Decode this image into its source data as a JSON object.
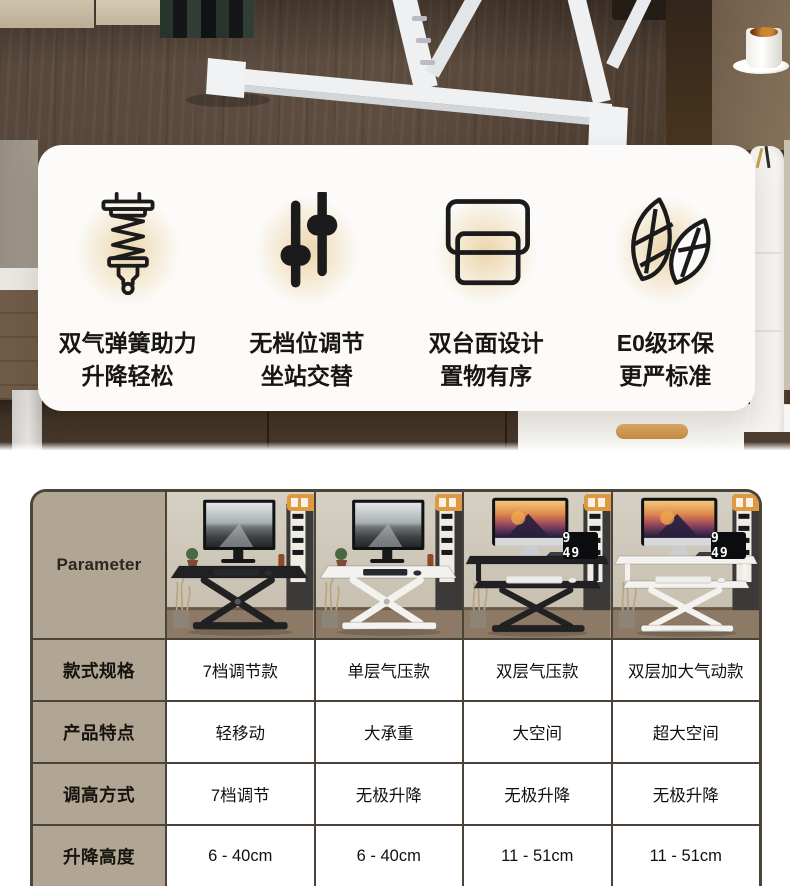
{
  "features": {
    "items": [
      {
        "icon": "gas-spring-icon",
        "title": "双气弹簧助力",
        "subtitle": "升降轻松"
      },
      {
        "icon": "slider-adjust-icon",
        "title": "无档位调节",
        "subtitle": "坐站交替"
      },
      {
        "icon": "dual-desktop-icon",
        "title": "双台面设计",
        "subtitle": "置物有序"
      },
      {
        "icon": "eco-leaf-icon",
        "title": "E0级环保",
        "subtitle": "更严标准"
      }
    ]
  },
  "comparison": {
    "header_label": "Parameter",
    "clock_display": "9 49",
    "row_labels": [
      "款式规格",
      "产品特点",
      "调高方式",
      "升降高度"
    ],
    "products": [
      {
        "style": "7档调节款",
        "feature": "轻移动",
        "adjust": "7档调节",
        "range": "6 - 40cm",
        "desk_color": "black",
        "tiers": "single"
      },
      {
        "style": "单层气压款",
        "feature": "大承重",
        "adjust": "无极升降",
        "range": "6 - 40cm",
        "desk_color": "white",
        "tiers": "single"
      },
      {
        "style": "双层气压款",
        "feature": "大空间",
        "adjust": "无极升降",
        "range": "11 - 51cm",
        "desk_color": "black",
        "tiers": "double"
      },
      {
        "style": "双层加大气动款",
        "feature": "超大空间",
        "adjust": "无极升降",
        "range": "11 - 51cm",
        "desk_color": "white",
        "tiers": "double"
      }
    ]
  },
  "colors": {
    "accent_tan": "#b1a593",
    "table_border": "#4a4337",
    "glow_gold": "#debb69",
    "tag_orange": "#dd9a42",
    "card_bg": "#fcfbf9"
  }
}
